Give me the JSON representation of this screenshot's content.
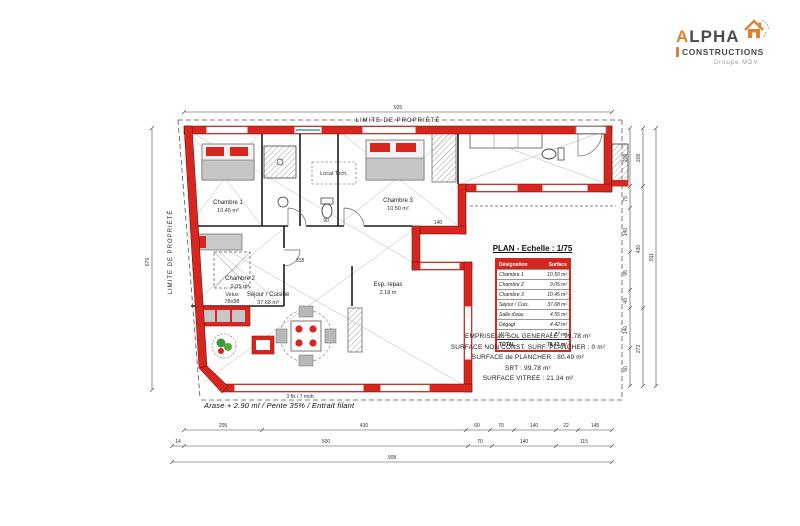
{
  "logo": {
    "brand": "ALPHA",
    "brand_sub": "CONSTRUCTIONS",
    "group": "Groupe MDV"
  },
  "header": {
    "plan_title": "PLAN - Echelle : 1/75"
  },
  "table": {
    "headers": [
      "Désignation",
      "Surface"
    ],
    "rows": [
      {
        "label": "Chambre 1",
        "value": "10.50 m²"
      },
      {
        "label": "Chambre 2",
        "value": "9.05 m²"
      },
      {
        "label": "Chambre 3",
        "value": "10.45 m²"
      },
      {
        "label": "Séjour / Cuis.",
        "value": "37.68 m²"
      },
      {
        "label": "Salle d'eau",
        "value": "4.55 m²"
      },
      {
        "label": "Dégagt",
        "value": "4.42 m²"
      },
      {
        "label": "W.C.",
        "value": "1.77 m²"
      }
    ],
    "total": {
      "label": "TOTAL",
      "value": "78.42 m²"
    }
  },
  "summary": {
    "line1": "EMPRISE au SOL GENERALE : 99.78 m²",
    "line2": "SURFACE NON CONST. SURF. PLANCHER : 0 m²",
    "line3": "SURFACE de PLANCHER : 80.49 m²",
    "line4": "SRT : 99.78 m²",
    "line5": "SURFACE VITREE : 21.34 m²"
  },
  "plan": {
    "boundary_top": "LIMITE DE PROPRIÉTÉ",
    "boundary_left": "LIMITE DE PROPRIÉTÉ",
    "note": "Arase + 2.90 ml / Pente 35% / Entrait filant",
    "bay_label": "3 fix / 7 mob",
    "rooms": {
      "ch1": {
        "name": "Chambre 1",
        "area": "10.45 m²"
      },
      "ch2": {
        "name": "Chambre 2",
        "area": "9.05 m²"
      },
      "ch3": {
        "name": "Chambre 3",
        "area": "10.50 m²"
      },
      "sejour": {
        "name": "Séjour / Cuisine",
        "area": "37.68 m²"
      },
      "repas": {
        "name": "Esp. repas",
        "area": "2.18 m"
      },
      "velux": {
        "name": "Velux",
        "area": "78x98"
      },
      "tech": {
        "name": "Local Tech."
      }
    },
    "dims": {
      "top": "925",
      "left": "679",
      "b1": [
        "205",
        "430",
        "60",
        "70",
        "140",
        "22",
        "145"
      ],
      "b2": [
        "14",
        "500",
        "70",
        "140",
        "115"
      ],
      "b3": [
        "908"
      ],
      "r1": [
        "208",
        "75",
        "140",
        "95",
        "40",
        "140",
        "50"
      ],
      "r2": [
        "208",
        "430",
        "273"
      ],
      "r3": [
        "911"
      ],
      "inner": [
        "90",
        "140",
        "318"
      ]
    },
    "colors": {
      "wall": "#d6261d",
      "accent": "#e2802f",
      "window_teal": "#2ba5a0"
    }
  }
}
